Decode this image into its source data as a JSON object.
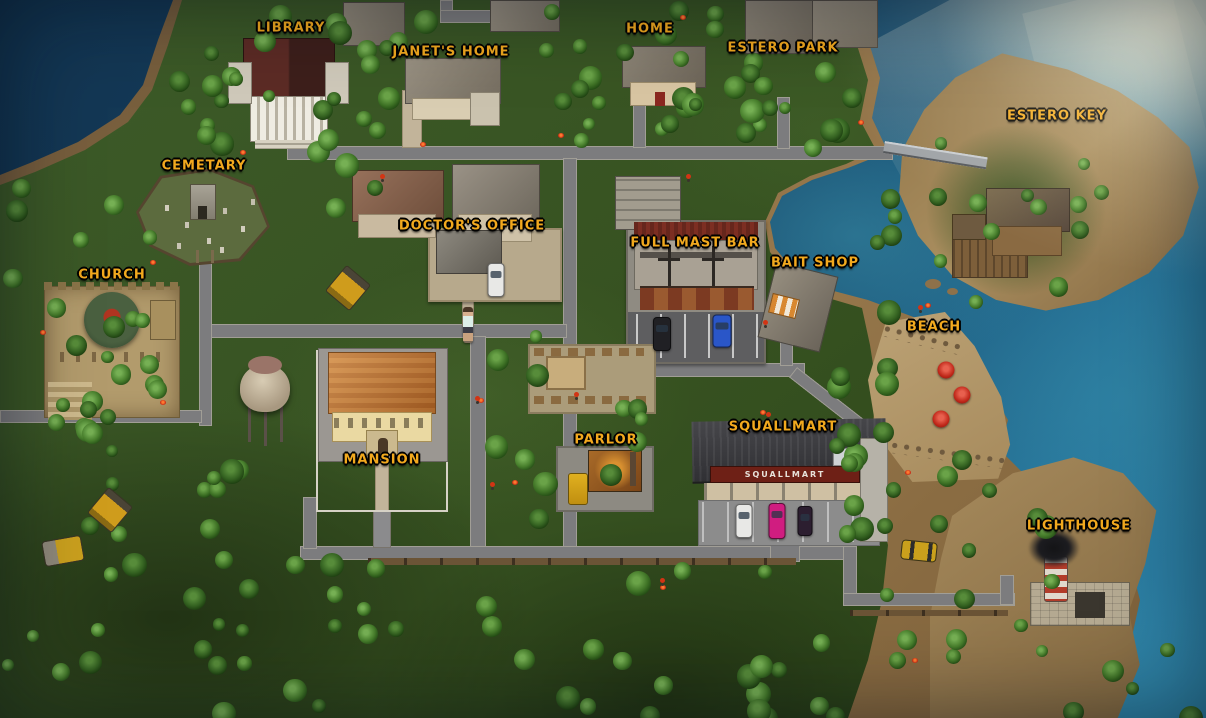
{
  "map": {
    "storefront_sign": "SQUALLMART",
    "labels": [
      {
        "id": "library",
        "text": "LIBRARY",
        "x": 291,
        "y": 28
      },
      {
        "id": "janets-home",
        "text": "JANET'S HOME",
        "x": 451,
        "y": 52
      },
      {
        "id": "home",
        "text": "HOME",
        "x": 650,
        "y": 29
      },
      {
        "id": "estero-park",
        "text": "ESTERO PARK",
        "x": 783,
        "y": 48
      },
      {
        "id": "estero-key",
        "text": "ESTERO KEY",
        "x": 1057,
        "y": 116
      },
      {
        "id": "cemetary",
        "text": "CEMETARY",
        "x": 204,
        "y": 166
      },
      {
        "id": "doctors-office",
        "text": "DOCTOR'S OFFICE",
        "x": 472,
        "y": 226
      },
      {
        "id": "full-mast-bar",
        "text": "FULL MAST BAR",
        "x": 695,
        "y": 243
      },
      {
        "id": "bait-shop",
        "text": "BAIT SHOP",
        "x": 815,
        "y": 263
      },
      {
        "id": "church",
        "text": "CHURCH",
        "x": 112,
        "y": 275
      },
      {
        "id": "beach",
        "text": "BEACH",
        "x": 934,
        "y": 327
      },
      {
        "id": "mansion",
        "text": "MANSION",
        "x": 382,
        "y": 460
      },
      {
        "id": "parlor",
        "text": "PARLOR",
        "x": 606,
        "y": 440
      },
      {
        "id": "squallmart",
        "text": "SQUALLMART",
        "x": 783,
        "y": 427
      },
      {
        "id": "lighthouse",
        "text": "LIGHTHOUSE",
        "x": 1079,
        "y": 526
      }
    ],
    "objects": [
      {
        "name": "player-character",
        "x": 468,
        "y": 325
      },
      {
        "name": "beach-umbrella",
        "x": 946,
        "y": 370
      },
      {
        "name": "beach-umbrella",
        "x": 962,
        "y": 395
      },
      {
        "name": "beach-umbrella",
        "x": 941,
        "y": 419
      },
      {
        "name": "bulldozer",
        "x": 110,
        "y": 510
      },
      {
        "name": "bulldozer",
        "x": 348,
        "y": 288
      },
      {
        "name": "steamroller",
        "x": 63,
        "y": 551
      },
      {
        "name": "school-bus",
        "x": 578,
        "y": 489
      },
      {
        "name": "taxi-car",
        "x": 919,
        "y": 551
      },
      {
        "name": "car-white",
        "x": 496,
        "y": 280
      },
      {
        "name": "car-black",
        "x": 662,
        "y": 334
      },
      {
        "name": "car-blue",
        "x": 722,
        "y": 331
      },
      {
        "name": "car-white",
        "x": 744,
        "y": 521
      },
      {
        "name": "car-pink",
        "x": 777,
        "y": 521
      },
      {
        "name": "car-dark",
        "x": 805,
        "y": 521
      }
    ],
    "colors": {
      "label_gold": "#f2a91e",
      "label_outline": "#000000",
      "ocean_deep": "#123450",
      "ocean_shallow": "#2f86ab",
      "sand": "#97784c",
      "grass": "#365120",
      "road": "#7c7c7e",
      "umbrella_red": "#c0281a"
    }
  }
}
